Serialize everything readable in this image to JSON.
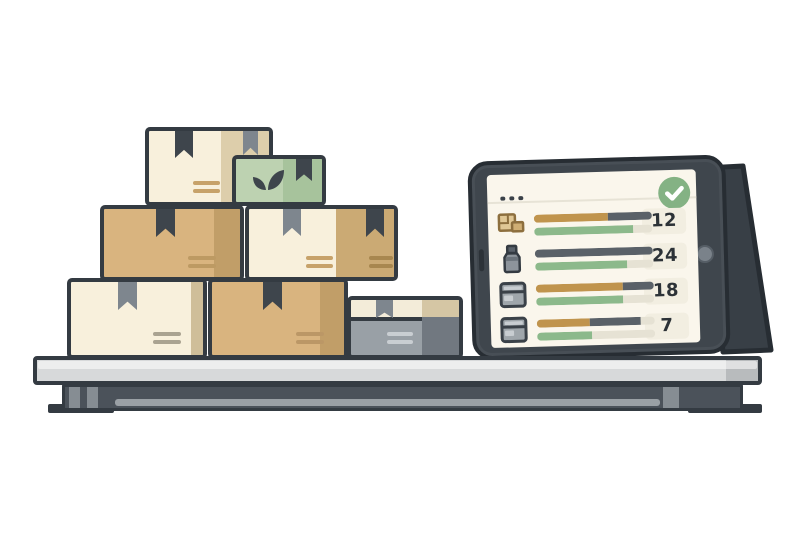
{
  "palette": {
    "outline": "#343b42",
    "tablet_frame": "#3f464d",
    "screen_bg": "#faf6ec",
    "bar_tan": "#c0944d",
    "bar_slate": "#5a6168",
    "bar_green": "#8cb98b",
    "bar_track": "#e6e2d4",
    "pill_bg": "#f2eee1",
    "number_color": "#2c3237",
    "check_green": "#84b284",
    "box_cream": "#f8f0dc",
    "box_cream_side": "#ddceab",
    "box_tan": "#d9b47f",
    "box_tan_side": "#c19e68",
    "box_green": "#bdd2b1",
    "box_green_side": "#a7c39c",
    "box_gray": "#99a0a6",
    "box_gray_dark": "#717880",
    "box_top_strip": "#f3ecd9",
    "tape_dark": "#3e454c",
    "tape_gray": "#7e868e",
    "label_gray": "#aaa391",
    "shelf_top": "#d7d9da",
    "shelf_top_cap": "#b8bbbd",
    "shelf_beam": "#4b525a"
  },
  "tablet": {
    "menu_icon": "three-dots",
    "status_icon": "checkmark-circle",
    "rows": [
      {
        "icon": "boxes-icon",
        "count": "12",
        "top_bar": [
          {
            "c": "tan",
            "pct": 63
          },
          {
            "c": "slate",
            "pct": 37
          }
        ],
        "bottom_bar": [
          {
            "c": "green",
            "pct": 84
          },
          {
            "c": "track",
            "pct": 16
          }
        ]
      },
      {
        "icon": "jar-icon",
        "count": "24",
        "top_bar": [
          {
            "c": "slate",
            "pct": 100
          }
        ],
        "bottom_bar": [
          {
            "c": "green",
            "pct": 78
          },
          {
            "c": "track",
            "pct": 22
          }
        ]
      },
      {
        "icon": "bin-icon",
        "count": "18",
        "top_bar": [
          {
            "c": "tan",
            "pct": 74
          },
          {
            "c": "slate",
            "pct": 26
          }
        ],
        "bottom_bar": [
          {
            "c": "green",
            "pct": 74
          },
          {
            "c": "track",
            "pct": 26
          }
        ]
      },
      {
        "icon": "bin-icon",
        "count": "7",
        "top_bar": [
          {
            "c": "tan",
            "pct": 45
          },
          {
            "c": "slate",
            "pct": 43
          },
          {
            "c": "track",
            "pct": 12
          }
        ],
        "bottom_bar": [
          {
            "c": "green",
            "pct": 47
          },
          {
            "c": "track",
            "pct": 53
          }
        ]
      }
    ]
  },
  "scene": {
    "boxes": [
      "cream-box",
      "green-box-with-leaf",
      "tan-box",
      "cream-and-tan-box",
      "cream-box",
      "tan-box",
      "gray-box"
    ],
    "furniture": [
      "shelf",
      "tablet-stand"
    ]
  }
}
